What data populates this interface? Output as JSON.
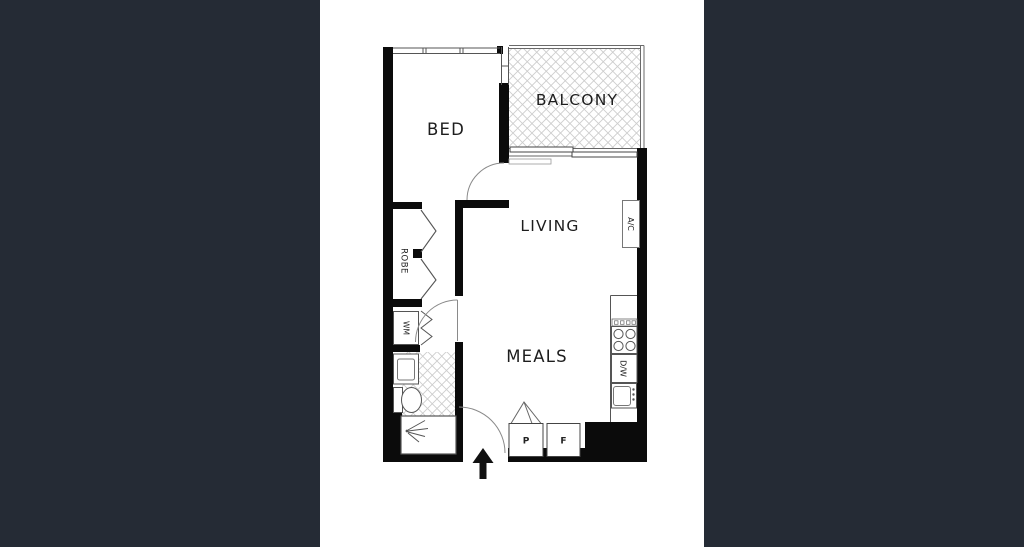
{
  "canvas": {
    "background": "#ffffff",
    "letterbox_color": "#252b35"
  },
  "floor_plan": {
    "type": "apartment-floor-plan",
    "rooms": {
      "bed": {
        "label": "BED"
      },
      "balcony": {
        "label": "BALCONY"
      },
      "living": {
        "label": "LIVING"
      },
      "meals": {
        "label": "MEALS"
      },
      "robe": {
        "label": "ROBE"
      }
    },
    "fixtures": {
      "air_conditioner": {
        "label": "A/C"
      },
      "washing_machine": {
        "label": "WM"
      },
      "dishwasher": {
        "label": "D/W"
      },
      "pantry": {
        "label": "P"
      },
      "fridge": {
        "label": "F"
      }
    },
    "colors": {
      "wall": "#0b0b0b",
      "thin_line": "#555555",
      "hatch_line": "#c9c9c9",
      "text": "#1d1d1d"
    }
  }
}
